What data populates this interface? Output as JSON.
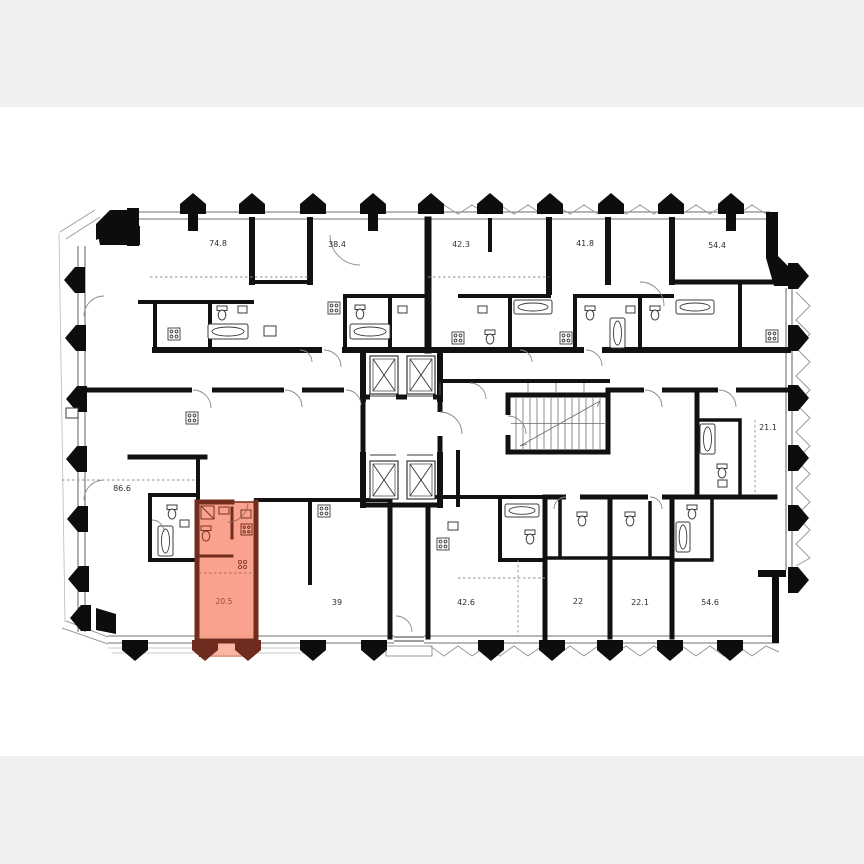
{
  "page": {
    "kind": "floor-plan-screenshot",
    "canvas_color": "#ffffff",
    "letterbox_color": "#efefef"
  },
  "floor_plan": {
    "type": "residential-floor-plan",
    "wall_color": "#111111",
    "highlight": {
      "fill": "#f89b84",
      "balcony_fill": "#f9b6a3",
      "wall_color": "#722c1d",
      "label_color": "#a34a35"
    },
    "features": {
      "elevators": "two banks of two shafts",
      "staircase": "central staircase core",
      "balconies": "zigzag balcony edging on right, top-center and bottom-center facades"
    },
    "units": [
      {
        "id": "unit-74-8",
        "area_label": "74.8",
        "highlighted": false
      },
      {
        "id": "unit-38-4",
        "area_label": "38.4",
        "highlighted": false
      },
      {
        "id": "unit-42-3",
        "area_label": "42.3",
        "highlighted": false
      },
      {
        "id": "unit-41-8",
        "area_label": "41.8",
        "highlighted": false
      },
      {
        "id": "unit-54-4",
        "area_label": "54.4",
        "highlighted": false
      },
      {
        "id": "unit-86-6",
        "area_label": "86.6",
        "highlighted": false
      },
      {
        "id": "unit-21-1",
        "area_label": "21.1",
        "highlighted": false
      },
      {
        "id": "unit-20-5",
        "area_label": "20.5",
        "highlighted": true
      },
      {
        "id": "unit-39",
        "area_label": "39",
        "highlighted": false
      },
      {
        "id": "unit-42-6",
        "area_label": "42.6",
        "highlighted": false
      },
      {
        "id": "unit-22",
        "area_label": "22",
        "highlighted": false
      },
      {
        "id": "unit-22-1",
        "area_label": "22.1",
        "highlighted": false
      },
      {
        "id": "unit-54-6",
        "area_label": "54.6",
        "highlighted": false
      }
    ]
  }
}
